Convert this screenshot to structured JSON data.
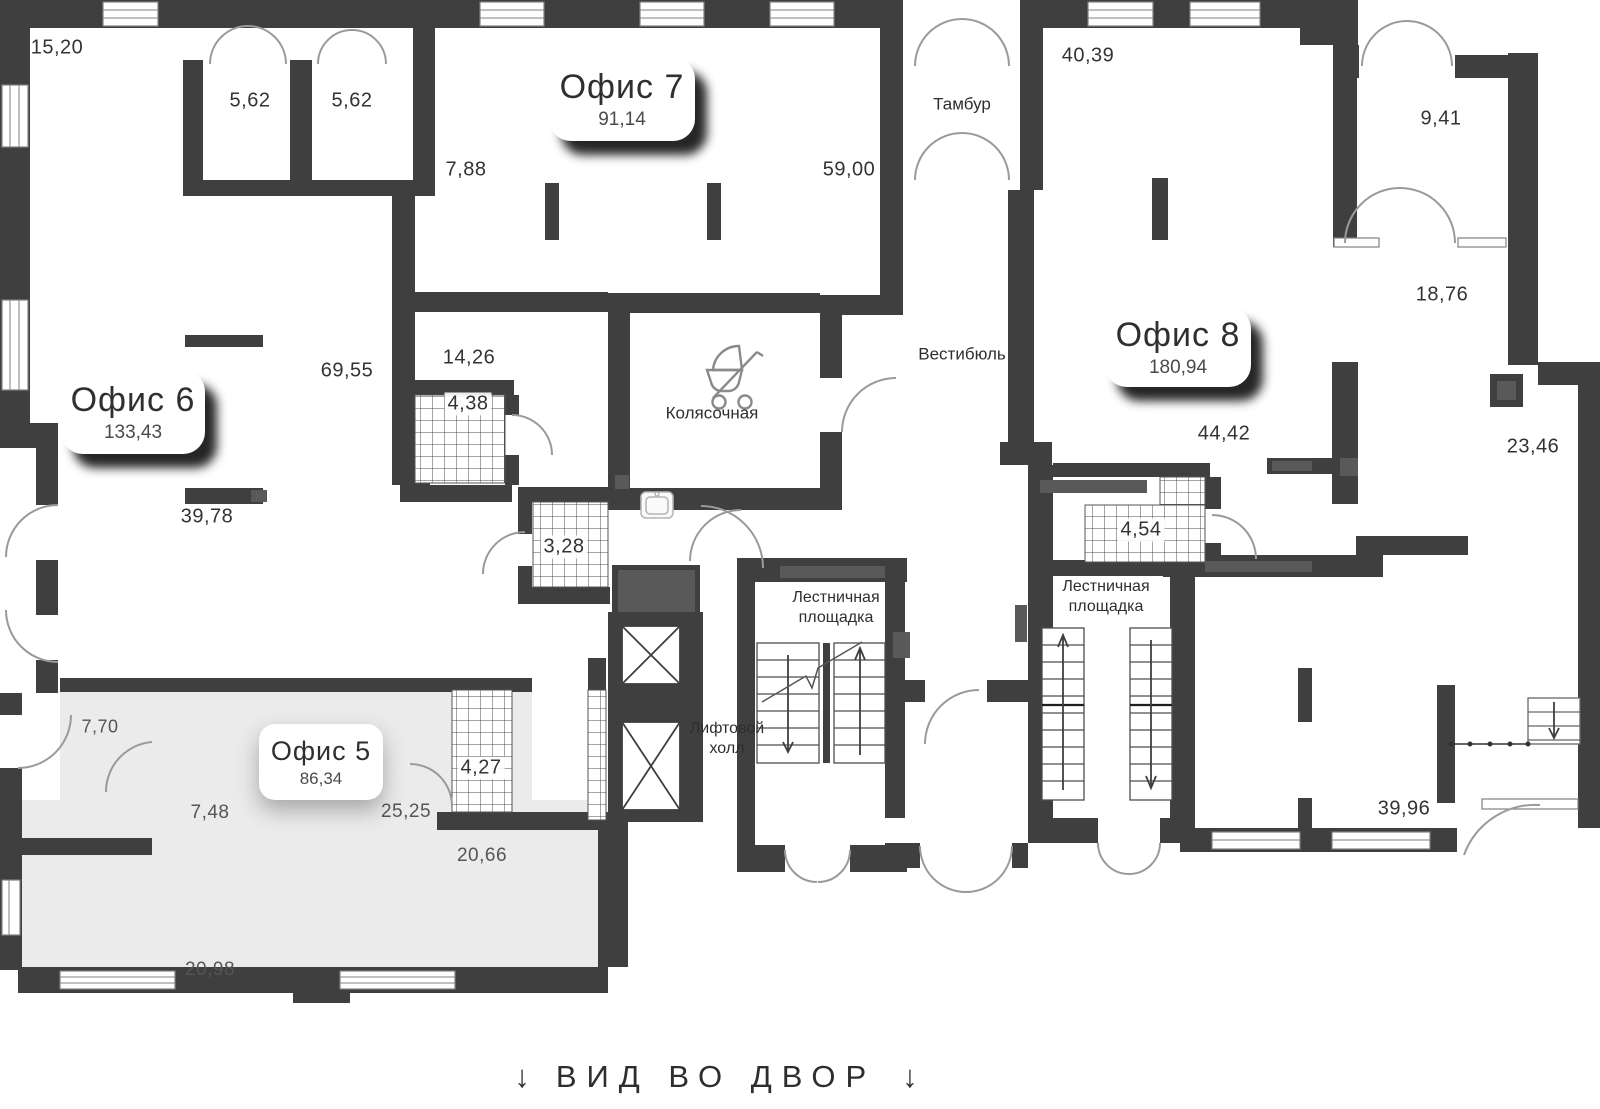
{
  "offices": {
    "o5": {
      "name": "Офис 5",
      "area": "86,34"
    },
    "o6": {
      "name": "Офис 6",
      "area": "133,43"
    },
    "o7": {
      "name": "Офис 7",
      "area": "91,14"
    },
    "o8": {
      "name": "Офис 8",
      "area": "180,94"
    }
  },
  "rooms": {
    "tambur": "Тамбур",
    "vestibule": "Вестибюль",
    "stroller_room": "Колясочная",
    "stair_landing_line1": "Лестничная",
    "stair_landing_line2": "площадка",
    "elevator_hall_line1": "Лифтовой",
    "elevator_hall_line2": "холл"
  },
  "dimensions": {
    "d15_20": "15,20",
    "d5_62a": "5,62",
    "d5_62b": "5,62",
    "d7_88": "7,88",
    "d59_00": "59,00",
    "d40_39": "40,39",
    "d9_41": "9,41",
    "d18_76": "18,76",
    "d14_26": "14,26",
    "d4_38": "4,38",
    "d3_28": "3,28",
    "d69_55": "69,55",
    "d39_78": "39,78",
    "d44_42": "44,42",
    "d23_46": "23,46",
    "d4_54": "4,54",
    "d4_27": "4,27",
    "d7_70": "7,70",
    "d7_48": "7,48",
    "d25_25": "25,25",
    "d20_66": "20,66",
    "d20_98": "20,98",
    "d39_96": "39,96"
  },
  "footer": {
    "arrow_left": "↓",
    "text": "ВИД ВО ДВОР",
    "arrow_right": "↓"
  },
  "colors": {
    "wall": "#3f3f3f",
    "wall_accent": "#595959",
    "office5_fill": "#ebebeb",
    "door_stroke": "#9a9a9a",
    "label_text": "#333333"
  }
}
